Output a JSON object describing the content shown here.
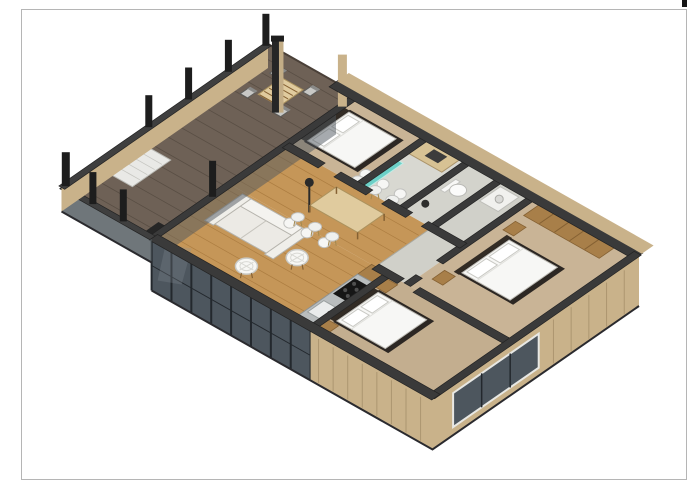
{
  "page": {
    "background": "#ffffff",
    "border_color": "#b5b5b5",
    "corner_mark_color": "#151515"
  },
  "scene": {
    "type": "3d-floor-plan-rendering",
    "objects": [
      "deck-terrace",
      "deck-posts",
      "deck-lounger",
      "outdoor-dining-table",
      "outdoor-chairs",
      "chimney-column",
      "planter-box",
      "living-room",
      "sofa",
      "wire-lounge-chairs",
      "floor-lamp",
      "dining-table",
      "dining-chairs",
      "kitchen-counter",
      "cooktop",
      "kitchen-sink",
      "bedroom-top",
      "bedroom-master",
      "bedroom-bottom",
      "bed",
      "wardrobe",
      "nightstand",
      "bathroom-vanity",
      "shower-glass",
      "toilet",
      "washing-machine",
      "hallway",
      "glass-wall",
      "exterior-wall"
    ]
  },
  "palette": {
    "deck_floor": "#6e6156",
    "deck_line": "#594e44",
    "deck_edge": "#4a4038",
    "oak": "#c59658",
    "oak_line": "#ac7d41",
    "carpet": "#c9b496",
    "carpet_dark": "#c3ae8f",
    "bath_floor": "#d8d8d1",
    "bath_floor2": "#d3d3cc",
    "hall_floor": "#d0d0c9",
    "wall_cap": "#3a3a3a",
    "wall_edge": "#232323",
    "ext_beige": "#c9b28a",
    "ext_beige_line": "#ac9670",
    "glass": "#4d565e",
    "glass_frame": "#23282d",
    "glass_deck": "#565e63",
    "post": "#1d1d1d",
    "chimney_dark": "#262626",
    "chimney_light": "#c3ad86",
    "mattress": "#f7f7f5",
    "frame_dark": "#2c2723",
    "headboard": "#332c25",
    "furn_stroke": "#bdbbb4",
    "white_furn": "#f1f1ee",
    "wood": "#a87f49",
    "wood_dark": "#856133",
    "counter": "#b9bdbe",
    "counter_edge": "#8e9292",
    "cooktop": "#161616",
    "sink": "#eaecec",
    "teal": "#5ed0c6",
    "table_top": "#e0cb9e",
    "table_edge": "#ab925e",
    "sofa_body": "#eceae5",
    "sofa_light": "#f4f3ef",
    "lounger": "#e9e9e6",
    "shadow": "#2a2a2e"
  }
}
